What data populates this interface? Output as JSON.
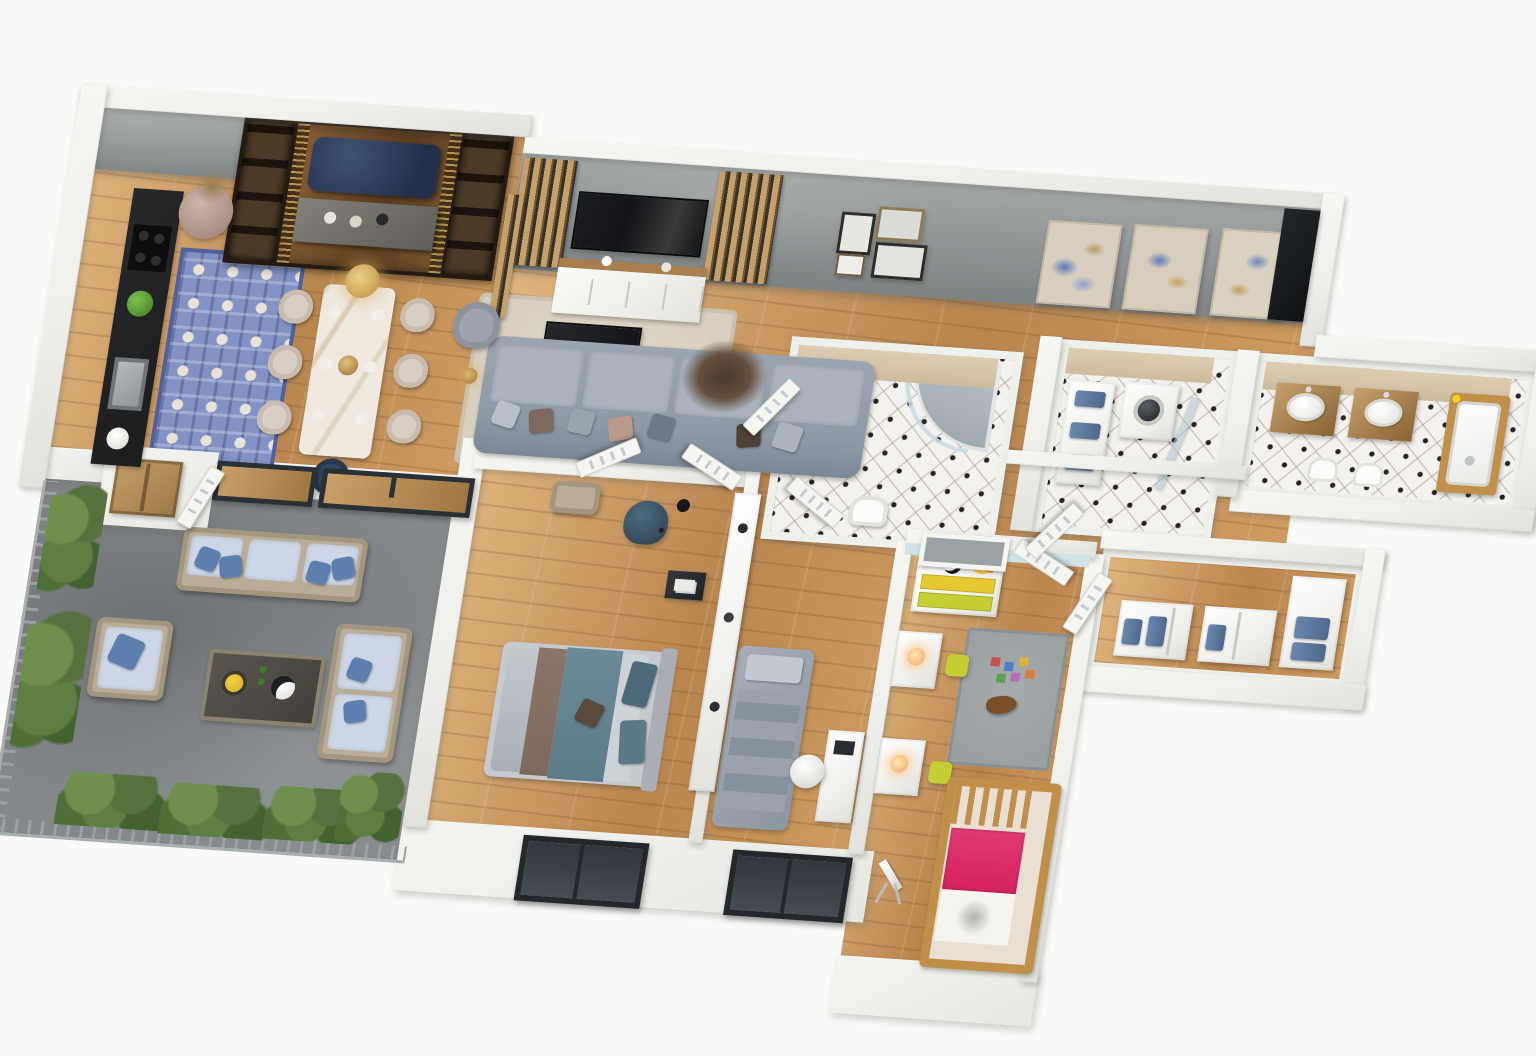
{
  "scene": {
    "type": "3d-floor-plan-render",
    "view": "isometric-overhead",
    "background": "#fafaf9"
  },
  "palette": {
    "wall": "#efefec",
    "concrete_wall": "#8f9394",
    "concrete_wall_dark": "#7d8283",
    "wood_floor": "#cf9d63",
    "wood_floor_dark": "#b9854f",
    "wood_floor_light": "#e0b47e",
    "terrace_floor": "#85888b",
    "tile_base": "#f4f2ee",
    "tile_dot": "#26231f",
    "tan_wall": "#cdbb9e",
    "dark_counter": "#1b1d1f",
    "dark_tv": "#121418",
    "wood_furniture": "#a97f4f",
    "wood_light": "#c5a06b",
    "slat_dark": "#6e5333",
    "marble": "#efe9e0",
    "chair_beige": "#d8cec3",
    "navy": "#33475e",
    "sofa_gray": "#8e99a6",
    "cushion_light": "#a9b2bd",
    "rug_living": "#d8cfc0",
    "rug_blue": "#8292c4",
    "rug_kids": "#9aa0a2",
    "outdoor_cushion": "#ccd6e6",
    "pillow_blue": "#5d7fae",
    "wicker": "#b9ad97",
    "plant_green": "#57713f",
    "plant_green_light": "#6f8f4d",
    "towel_blue": "#6b87ae",
    "teal_bed": "#5e7b8a",
    "brown_throw": "#7d6a5e",
    "bed_frame": "#c6c9cd",
    "yellow_drawer": "#e8c832",
    "lime": "#c5cf33",
    "pink": "#d5205f",
    "crib_wood": "#c08f4a",
    "light_blue_wall": "#cfe3e6",
    "gold": "#c9a24b",
    "window_frame": "#24282c",
    "window_glass": "#454c52",
    "white_furn": "#f0f0ed"
  },
  "rooms": [
    {
      "name": "kitchen-dining",
      "furniture": [
        "tall wood cabinet",
        "black kitchen counter",
        "sink",
        "cooktop",
        "clay vase",
        "blue patterned rug",
        "marble dining table",
        "beige dining chairs",
        "navy end chair",
        "brass chandelier",
        "gray lounge chair",
        "gold floor lamp",
        "wood slat partition"
      ]
    },
    {
      "name": "foyer-media-wall",
      "furniture": [
        "lit display shelf",
        "wood feature wall",
        "navy tufted bench",
        "gray console",
        "lit display shelf"
      ]
    },
    {
      "name": "living-room",
      "furniture": [
        "wood slat panel",
        "wall tv",
        "media sideboard",
        "framed photos",
        "area rug",
        "black coffee table",
        "gray sectional sofa",
        "fur throw"
      ]
    },
    {
      "name": "gallery-hall",
      "furniture": [
        "abstract painting",
        "abstract painting",
        "abstract painting",
        "dark wardrobe"
      ]
    },
    {
      "name": "shower-bathroom",
      "furniture": [
        "wood vanity",
        "vessel sink",
        "curved glass shower",
        "toilet"
      ]
    },
    {
      "name": "laundry-room",
      "furniture": [
        "towel shelf",
        "washing machine",
        "glass shower screen"
      ]
    },
    {
      "name": "master-bathroom",
      "furniture": [
        "wood vanity",
        "wood vanity",
        "wood-clad bathtub",
        "toilet",
        "bidet"
      ]
    },
    {
      "name": "walk-in-closet",
      "furniture": [
        "shelf module with towels",
        "shelf module with towels",
        "corner wardrobe"
      ]
    },
    {
      "name": "master-bedroom",
      "furniture": [
        "open wardrobe",
        "wicker bench",
        "teal reading chair",
        "black arc lamp",
        "side table",
        "double bed",
        "window"
      ]
    },
    {
      "name": "guest-bedroom",
      "furniture": [
        "gray daybed",
        "white desk",
        "desk chair",
        "bookcase",
        "window"
      ]
    },
    {
      "name": "kids-room",
      "furniture": [
        "yellow dresser",
        "toy duck",
        "soccer ball",
        "kids desk",
        "kids desk",
        "lime stool",
        "lime stool",
        "play rug",
        "toy blocks",
        "rocking horse",
        "wooden crib bed",
        "telescope",
        "interior window"
      ]
    },
    {
      "name": "terrace",
      "furniture": [
        "metal railing",
        "planter",
        "planter",
        "hedge",
        "shrub",
        "outdoor sofa",
        "outdoor armchair",
        "outdoor loveseat",
        "coffee table",
        "fruit bowl",
        "sliding glass door",
        "sliding glass door"
      ]
    },
    {
      "name": "entry-vestibule",
      "furniture": [
        "storage bench",
        "slatted door"
      ]
    }
  ]
}
